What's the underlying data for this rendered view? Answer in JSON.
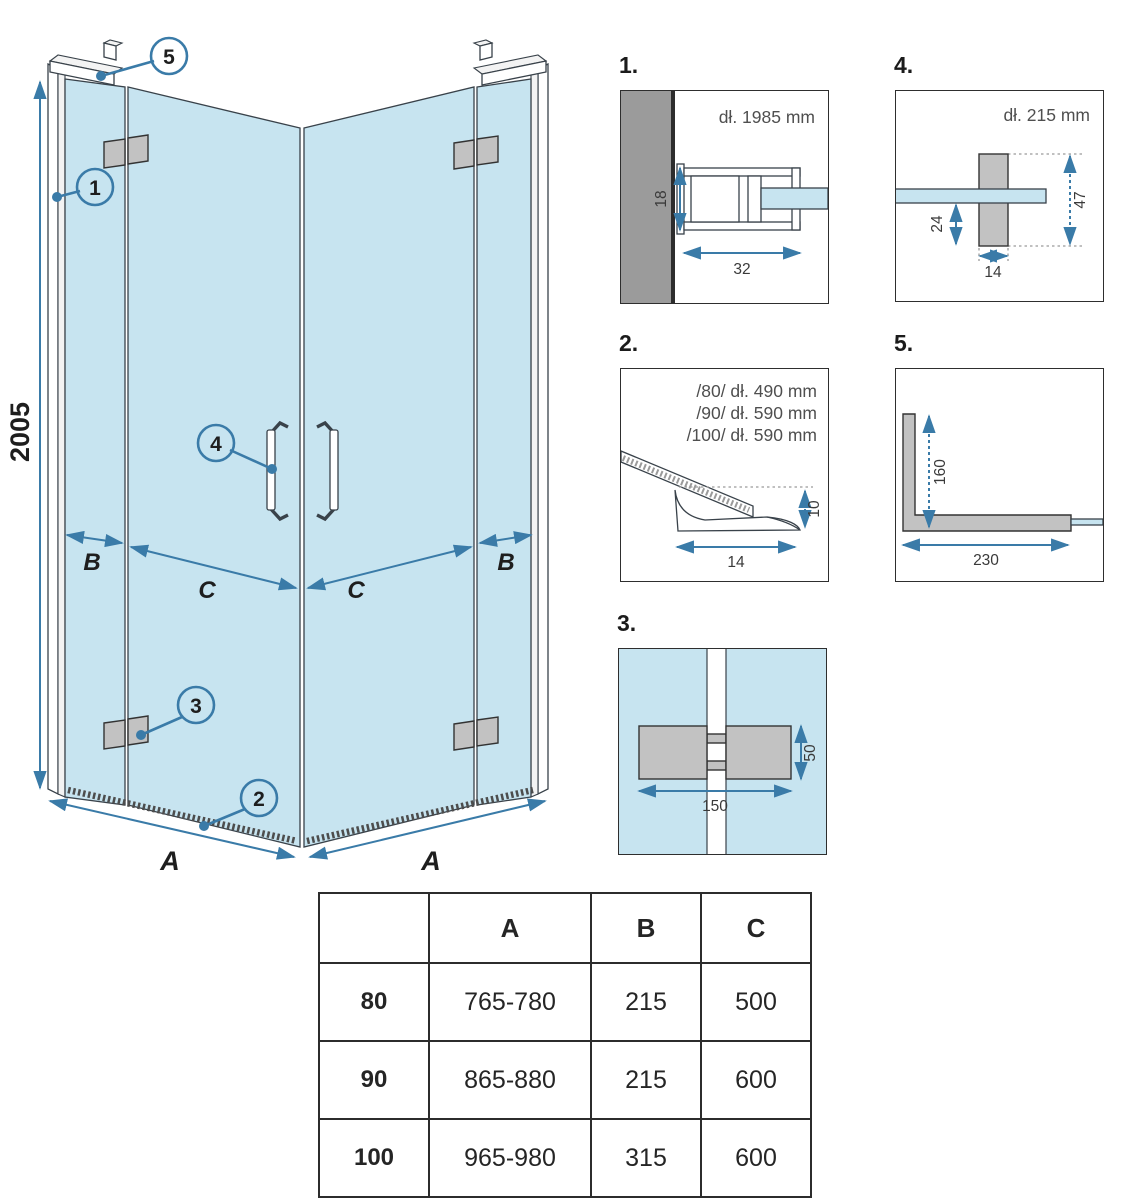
{
  "colors": {
    "accent": "#3a7ba8",
    "glass": "#c7e4f0",
    "part": "#c2c2c2",
    "wall": "#9b9b9b"
  },
  "main": {
    "height_dim": "2005",
    "a_left": "A",
    "a_right": "A",
    "b_left": "B",
    "c_left": "C",
    "c_right": "C",
    "b_right": "B",
    "callouts": {
      "c1": "1",
      "c2": "2",
      "c3": "3",
      "c4": "4",
      "c5": "5"
    }
  },
  "details": {
    "d1": {
      "label": "1.",
      "note": "dł. 1985 mm",
      "dims": {
        "h": "18",
        "w": "32"
      }
    },
    "d2": {
      "label": "2.",
      "notes": [
        "/80/ dł. 490 mm",
        "/90/ dł. 590 mm",
        "/100/ dł. 590 mm"
      ],
      "dims": {
        "w": "14",
        "h": "10"
      }
    },
    "d3": {
      "label": "3.",
      "dims": {
        "w": "150",
        "h": "50"
      }
    },
    "d4": {
      "label": "4.",
      "note": "dł. 215 mm",
      "dims": {
        "offset": "24",
        "h": "47",
        "w": "14"
      }
    },
    "d5": {
      "label": "5.",
      "dims": {
        "v": "160",
        "h": "230"
      }
    }
  },
  "table": {
    "headers": [
      "",
      "A",
      "B",
      "C"
    ],
    "rows": [
      [
        "80",
        "765-780",
        "215",
        "500"
      ],
      [
        "90",
        "865-880",
        "215",
        "600"
      ],
      [
        "100",
        "965-980",
        "315",
        "600"
      ]
    ]
  }
}
